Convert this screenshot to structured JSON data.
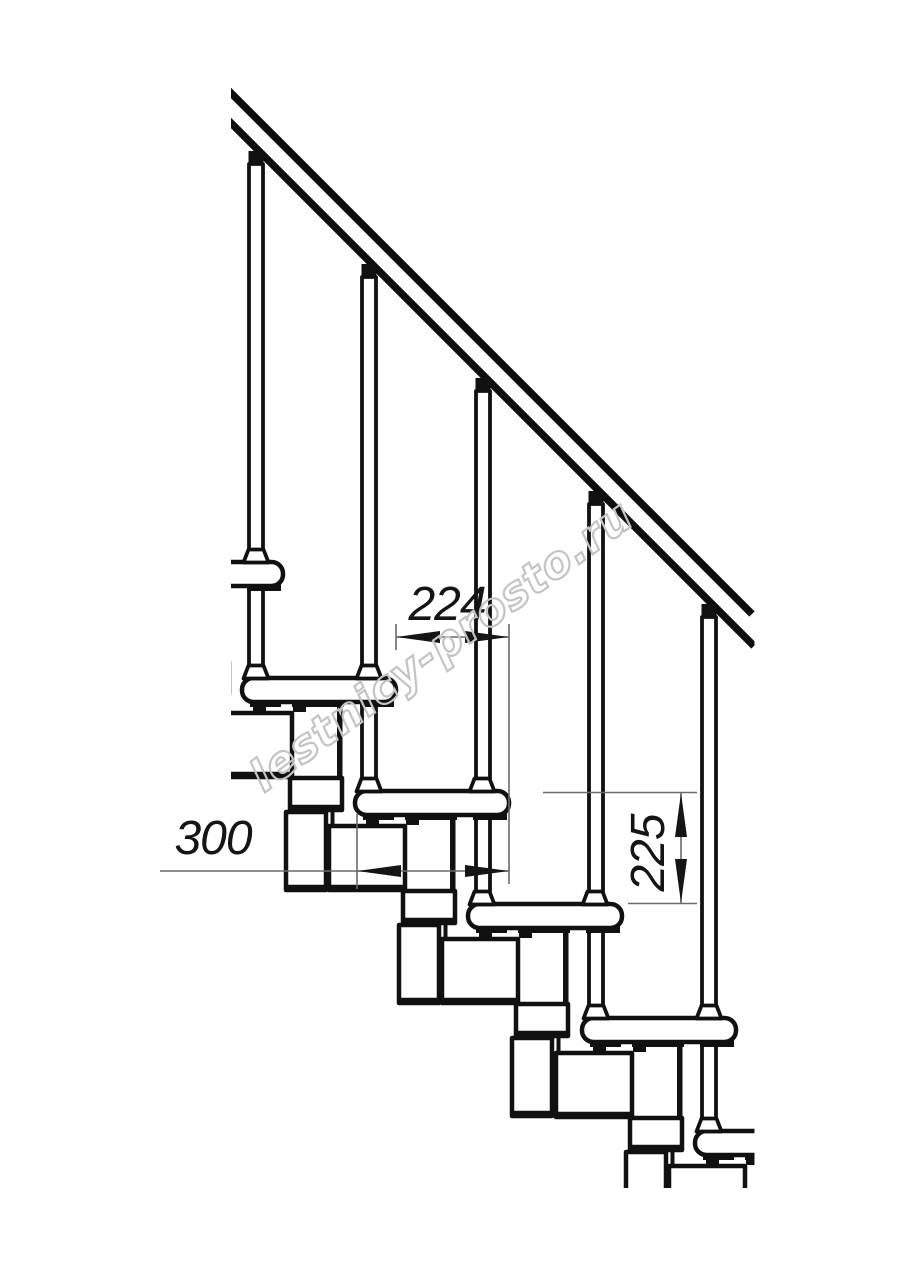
{
  "drawing": {
    "title": "modular-staircase-side-elevation",
    "dimensions": {
      "step_run_label": "224",
      "tread_depth_label": "300",
      "step_rise_label": "225"
    },
    "watermark": {
      "text": "lestnicy-prosto.ru"
    },
    "counts": {
      "balusters": 5,
      "treads": 6,
      "support_modules": 5
    },
    "colors": {
      "line": "#111111",
      "dimension_line": "#6a6a6a",
      "dimension_text": "#151515",
      "watermark": "#c4c4c4",
      "background": "#ffffff"
    }
  }
}
